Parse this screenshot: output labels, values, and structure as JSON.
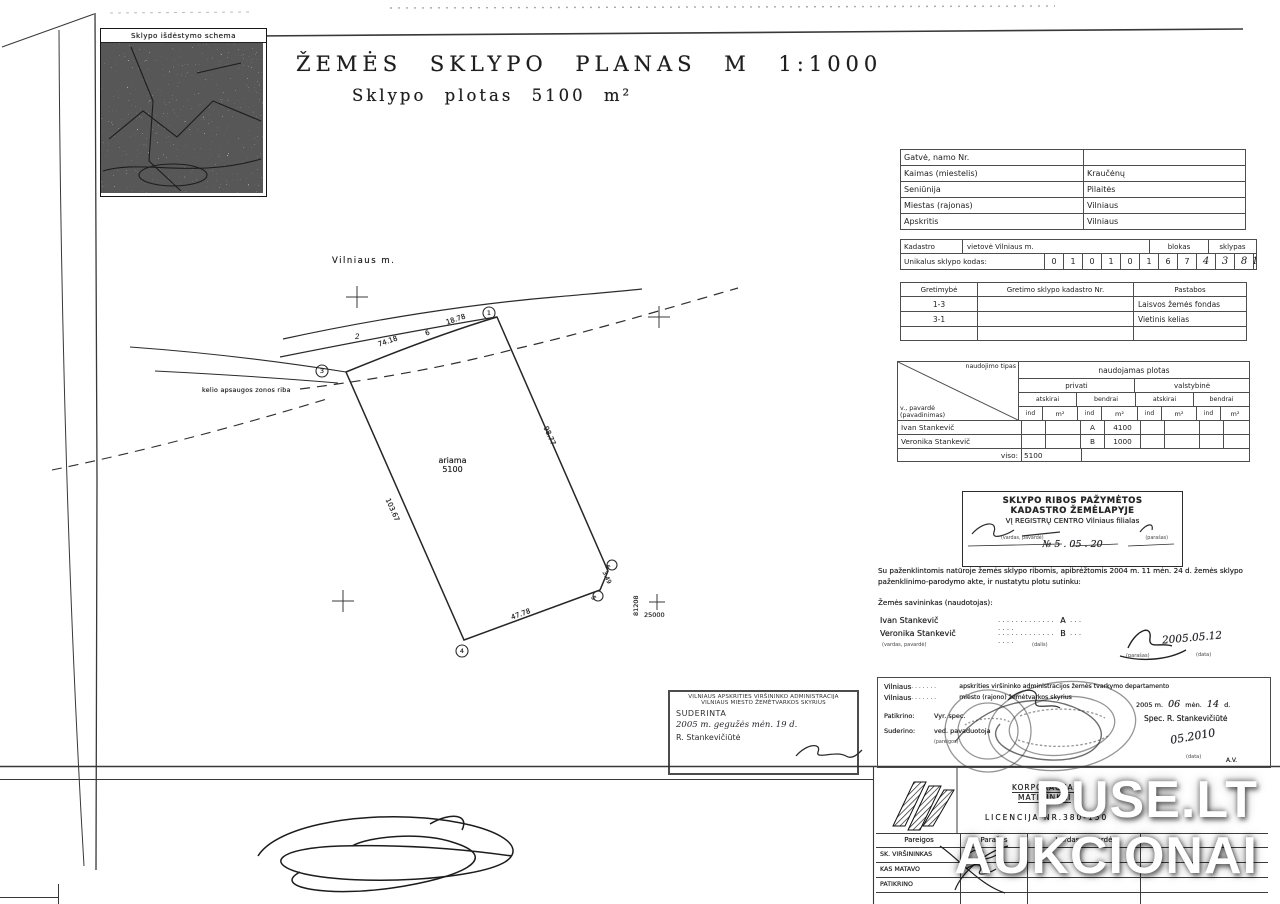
{
  "watermark": {
    "line1": "PUSE.LT",
    "line2": "AUKCIONAI"
  },
  "minimap": {
    "title": "Sklypo išdėstymo schema"
  },
  "title": {
    "main": "ŽEMĖS SKLYPO PLANAS M 1:1000",
    "sub": "Sklypo plotas 5100 m²"
  },
  "plan": {
    "city": "Vilniaus m.",
    "zone": "kelio apsaugos zonos riba",
    "area_label": "ariama",
    "area_value": "5100",
    "v1": "1",
    "v2": "2",
    "v3": "3",
    "v4": "4",
    "v5": "5",
    "v6": "6",
    "d_top1": "74.18",
    "d_top2": "6",
    "d_top3": "18.78",
    "d_right": "98.77",
    "d_corner": "3.49",
    "d_bottom": "47.78",
    "d_left": "103.67",
    "grid_y": "81208",
    "grid_x": "25000"
  },
  "address": {
    "rows": [
      {
        "label": "Gatvė, namo Nr.",
        "value": ""
      },
      {
        "label": "Kaimas (miestelis)",
        "value": "Kraučėnų"
      },
      {
        "label": "Seniūnija",
        "value": "Pilaitės"
      },
      {
        "label": "Miestas (rajonas)",
        "value": "Vilniaus"
      },
      {
        "label": "Apskritis",
        "value": "Vilniaus"
      }
    ]
  },
  "cadastre": {
    "label": "Kadastro",
    "place": "vietovė Vilniaus m.",
    "blokas": "blokas",
    "sklypas": "sklypas",
    "code_label": "Unikalus sklypo kodas:",
    "digits": [
      "0",
      "1",
      "0",
      "1",
      "0",
      "1",
      "6",
      "7"
    ],
    "hand": [
      "4",
      "3",
      "8",
      "1"
    ]
  },
  "adjacency": {
    "h1": "Gretimybė",
    "h2": "Gretimo sklypo kadastro Nr.",
    "h3": "Pastabos",
    "rows": [
      {
        "c1": "1-3",
        "c2": "",
        "c3": "Laisvos žemės fondas"
      },
      {
        "c1": "3-1",
        "c2": "",
        "c3": "Vietinis kelias"
      },
      {
        "c1": "",
        "c2": "",
        "c3": ""
      }
    ]
  },
  "usage": {
    "corner_top": "naudojimo tipas",
    "corner_bottom": "v., pavardė (pavadinimas)",
    "span": "naudojamas plotas",
    "privati": "privati",
    "valstybine": "valstybinė",
    "atskirai": "atskirai",
    "bendrai": "bendrai",
    "ind": "ind",
    "m2": "m²",
    "rows": [
      {
        "name": "Ivan Stankevič",
        "ind": "A",
        "plotas": "4100"
      },
      {
        "name": "Veronika Stankevič",
        "ind": "B",
        "plotas": "1000"
      }
    ],
    "total_label": "viso:",
    "total": "5100"
  },
  "registry": {
    "line1": "SKLYPO RIBOS PAŽYMĖTOS",
    "line2": "KADASTRO ŽEMĖLAPYJE",
    "line3": "VĮ REGISTRŲ CENTRO Vilniaus filialas",
    "sub1": "(vardas, pavardė)",
    "sub2": "(parašas)",
    "hand": "№ 5 .  05  .  20"
  },
  "agreement": {
    "text": "Su paženklintomis natūroje žemės sklypo ribomis, apibrėžtomis 2004 m. 11 mėn. 24 d. žemės sklypo paženklinimo-parodymo akte, ir nustatytu plotu sutinku:",
    "owner": "Žemės savininkas (naudotojas):",
    "name1": "Ivan Stankevič",
    "share1": "A",
    "name2": "Veronika Stankevič",
    "share2": "B",
    "dots": ". . . . . . . . . . . . . . . . .",
    "dots_s": ". . .",
    "sub_name": "(vardas, pavardė)",
    "sub_share": "(dalis)",
    "sub_sign": "(parašas)",
    "date": "2005.05.12",
    "sub_date": "(data)"
  },
  "suderinta": {
    "line1": "VILNIAUS APSKRITIES VIRŠININKO ADMINISTRACIJA",
    "line2": "VILNIAUS MIESTO ŽEMĖTVARKOS SKYRIUS",
    "line3": "SUDERINTA",
    "hand": "2005 m. gegužės mėn. 19 d.",
    "name": "R. Stankevičiūtė"
  },
  "approval": {
    "l1a": "Vilniaus",
    "l1b": "apskrities viršininko administracijos žemės tvarkymo departamento",
    "l2a": "Vilniaus",
    "l2b": "miesto (rajono) žemėtvarkos skyrius",
    "date1": "2005 m.",
    "m": "06",
    "mlab": "mėn.",
    "d": "14",
    "dlab": "d.",
    "checked": "Patikrino:",
    "agreed": "Suderino:",
    "pos1": "Vyr. spec.",
    "pos2": "ved. pavaduotoja",
    "sub_pos": "(pareigos)",
    "spec": "Spec. R. Stankevičiūtė",
    "hand_date": "05.2010",
    "sub_date": "(data)",
    "seal": "A.V.",
    "dots": ". . . . . . ."
  },
  "firm": {
    "name1": "KORPORACIJA",
    "name2": "MATININKAI",
    "licence": "LICENCIJA NR.380-150",
    "h1": "Pareigos",
    "h2": "Parašas",
    "h3": "Vardas, pavardė",
    "rows": [
      "SK. VIRŠININKAS",
      "KAS MATAVO",
      "PATIKRINO"
    ]
  }
}
